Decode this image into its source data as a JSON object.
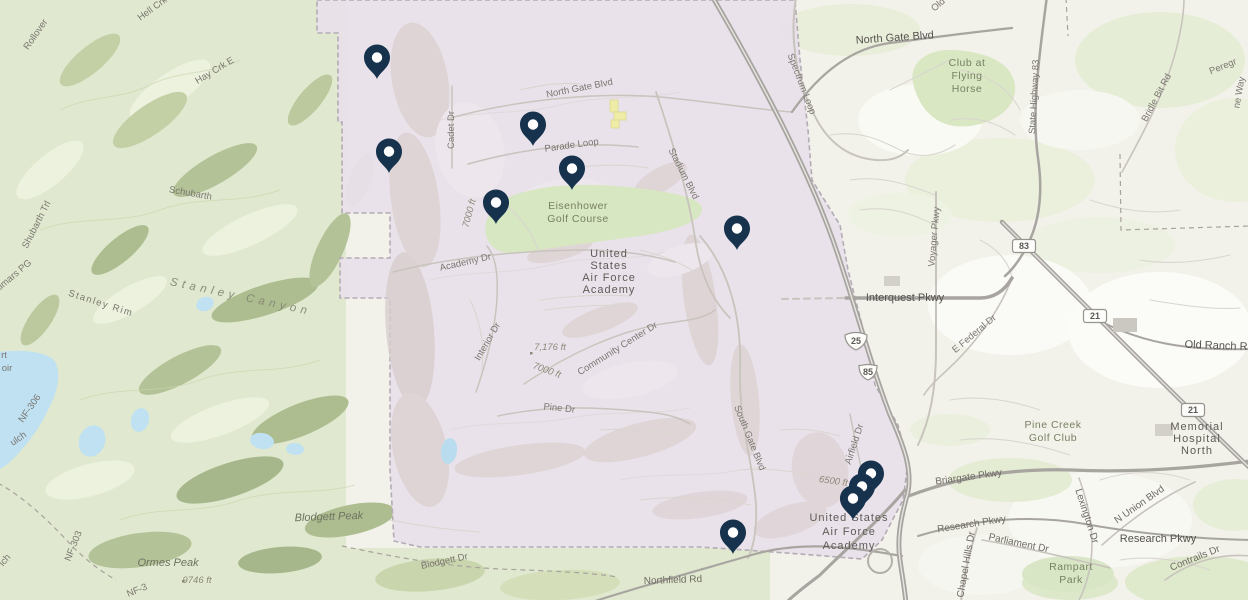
{
  "map": {
    "colors": {
      "pin": "#16324d",
      "pin_hole": "#ffffff",
      "boundary_fill": "#e8e0ea",
      "boundary_stroke": "#b3abb5",
      "terrain_green": "#e0e9cf",
      "urban_cream": "#f3f2ea",
      "water": "#bfe1f1",
      "golf_green": "#d7e7c1",
      "building_yellow": "#eeeca6"
    },
    "labels": [
      {
        "t": "Rollover",
        "x": 38,
        "y": 36,
        "r": -55,
        "s": "roadsm"
      },
      {
        "t": "Hell Crk",
        "x": 154,
        "y": 11,
        "r": -36,
        "s": "roadsm"
      },
      {
        "t": "Hay Crk E",
        "x": 216,
        "y": 73,
        "r": -31,
        "s": "roadsm"
      },
      {
        "t": "Schubarth",
        "x": 190,
        "y": 196,
        "r": 10,
        "s": "roadsm"
      },
      {
        "t": "Shubarth Trl",
        "x": 39,
        "y": 226,
        "r": -63,
        "s": "roadsm"
      },
      {
        "t": "almars PG",
        "x": 15,
        "y": 278,
        "r": -40,
        "s": "roadsm"
      },
      {
        "t": "Stanley Rim",
        "x": 100,
        "y": 306,
        "r": 18,
        "s": "roadsm",
        "ls": 1.5
      },
      {
        "t": "Stanley Canyon",
        "x": 240,
        "y": 300,
        "r": 12,
        "s": "canyon"
      },
      {
        "t": "rt",
        "x": 4,
        "y": 358,
        "s": "roadsm"
      },
      {
        "t": "oir",
        "x": 7,
        "y": 371,
        "s": "roadsm"
      },
      {
        "t": "NF-306",
        "x": 32,
        "y": 410,
        "r": -55,
        "s": "roadsm"
      },
      {
        "t": "ulch",
        "x": 20,
        "y": 441,
        "r": -35,
        "s": "roadsm"
      },
      {
        "t": "lch",
        "x": 7,
        "y": 562,
        "r": -50,
        "s": "roadsm"
      },
      {
        "t": "NF-303",
        "x": 76,
        "y": 547,
        "r": -68,
        "s": "roadsm"
      },
      {
        "t": "Ormes Peak",
        "x": 168,
        "y": 566,
        "s": "peak"
      },
      {
        "t": "9746 ft",
        "x": 197,
        "y": 583,
        "s": "elev"
      },
      {
        "t": "NF-3",
        "x": 138,
        "y": 593,
        "r": -22,
        "s": "roadsm"
      },
      {
        "t": "Blodgett Peak",
        "x": 329,
        "y": 520,
        "r": -2,
        "s": "peak"
      },
      {
        "t": "Blodgett Dr",
        "x": 445,
        "y": 564,
        "r": -12,
        "s": "roadsm"
      },
      {
        "t": "Northfield Rd",
        "x": 673,
        "y": 583,
        "r": -2,
        "s": "road"
      },
      {
        "t": "North Gate Blvd",
        "x": 580,
        "y": 91,
        "r": -11,
        "s": "roadsm"
      },
      {
        "t": "Cadet Dr",
        "x": 454,
        "y": 130,
        "r": -90,
        "s": "roadsm"
      },
      {
        "t": "Parade Loop",
        "x": 572,
        "y": 148,
        "r": -8,
        "s": "roadsm"
      },
      {
        "t": "Stadium Blvd",
        "x": 681,
        "y": 175,
        "r": 63,
        "s": "roadsm"
      },
      {
        "t": "Academy Dr",
        "x": 466,
        "y": 265,
        "r": -13,
        "s": "roadsm"
      },
      {
        "t": "7000 ft",
        "x": 472,
        "y": 214,
        "r": -75,
        "s": "elev"
      },
      {
        "t": "Interior Dr",
        "x": 490,
        "y": 343,
        "r": -60,
        "s": "roadsm"
      },
      {
        "t": "7,176 ft",
        "x": 550,
        "y": 350,
        "s": "elev"
      },
      {
        "t": "7000 ft",
        "x": 546,
        "y": 373,
        "r": 20,
        "s": "elev"
      },
      {
        "t": "Community Center Dr",
        "x": 619,
        "y": 351,
        "r": -32,
        "s": "roadsm"
      },
      {
        "t": "Pine Dr",
        "x": 559,
        "y": 411,
        "r": 6,
        "s": "roadsm"
      },
      {
        "t": "South Gate Blvd",
        "x": 747,
        "y": 439,
        "r": 68,
        "s": "roadsm"
      },
      {
        "t": "Airfield Dr",
        "x": 857,
        "y": 445,
        "r": -72,
        "s": "roadsm"
      },
      {
        "t": "6500 ft",
        "x": 833,
        "y": 484,
        "r": 8,
        "s": "elev"
      },
      {
        "t": "Spectrum Loop",
        "x": 799,
        "y": 85,
        "r": 69,
        "s": "roadsm"
      },
      {
        "t": "Old",
        "x": 940,
        "y": 7,
        "r": -40,
        "s": "roadsm"
      },
      {
        "t": "North Gate Blvd",
        "x": 895,
        "y": 41,
        "r": -4,
        "s": "major"
      },
      {
        "t": "State Highway 83",
        "x": 1037,
        "y": 97,
        "r": -87,
        "s": "roadsm"
      },
      {
        "t": "Bridle Bit Rd",
        "x": 1159,
        "y": 99,
        "r": -62,
        "s": "roadsm"
      },
      {
        "t": "Peregr",
        "x": 1224,
        "y": 69,
        "r": -22,
        "s": "roadsm"
      },
      {
        "t": "ne Way",
        "x": 1242,
        "y": 93,
        "r": -80,
        "s": "roadsm"
      },
      {
        "t": "Voyager Pkwy",
        "x": 937,
        "y": 237,
        "r": -85,
        "s": "roadsm"
      },
      {
        "t": "Interquest Pkwy",
        "x": 905,
        "y": 301,
        "s": "major"
      },
      {
        "t": "E Federal Dr",
        "x": 976,
        "y": 336,
        "r": -40,
        "s": "roadsm"
      },
      {
        "t": "Old Ranch Rd",
        "x": 1219,
        "y": 349,
        "r": 2,
        "s": "major"
      },
      {
        "t": "Briargate Pkwy",
        "x": 969,
        "y": 480,
        "r": -8,
        "s": "road"
      },
      {
        "t": "Research Pkwy",
        "x": 972,
        "y": 527,
        "r": -9,
        "s": "road"
      },
      {
        "t": "Research Pkwy",
        "x": 1158,
        "y": 542,
        "s": "major"
      },
      {
        "t": "Chapel Hills Dr",
        "x": 969,
        "y": 565,
        "r": -80,
        "s": "road"
      },
      {
        "t": "Parliament Dr",
        "x": 1018,
        "y": 546,
        "r": 12,
        "s": "road"
      },
      {
        "t": "Lexington Dr",
        "x": 1084,
        "y": 517,
        "r": 72,
        "s": "road"
      },
      {
        "t": "N Union Blvd",
        "x": 1141,
        "y": 507,
        "r": -35,
        "s": "road"
      },
      {
        "t": "Contrails Dr",
        "x": 1196,
        "y": 561,
        "r": -22,
        "s": "road"
      },
      {
        "lines": [
          "Eisenhower",
          "Golf Course"
        ],
        "x": 578,
        "y": 209,
        "lh": 13,
        "s": "park"
      },
      {
        "lines": [
          "United",
          "States",
          "Air Force",
          "Academy"
        ],
        "x": 609,
        "y": 257,
        "lh": 12,
        "s": "place"
      },
      {
        "lines": [
          "United States",
          "Air Force",
          "Academy"
        ],
        "x": 849,
        "y": 521,
        "lh": 14,
        "s": "place",
        "size": 12.5
      },
      {
        "lines": [
          "Club at",
          "Flying",
          "Horse"
        ],
        "x": 967,
        "y": 66,
        "lh": 13,
        "s": "park"
      },
      {
        "lines": [
          "Pine Creek",
          "Golf Club"
        ],
        "x": 1053,
        "y": 428,
        "lh": 13,
        "s": "park"
      },
      {
        "lines": [
          "Memorial",
          "Hospital",
          "North"
        ],
        "x": 1197,
        "y": 430,
        "lh": 12,
        "s": "place"
      },
      {
        "lines": [
          "Rampart",
          "Park"
        ],
        "x": 1071,
        "y": 570,
        "lh": 13,
        "s": "park"
      }
    ],
    "shields": [
      {
        "kind": "interstate",
        "label": "25",
        "x": 856,
        "y": 341
      },
      {
        "kind": "us",
        "label": "85",
        "x": 868,
        "y": 372
      },
      {
        "kind": "state",
        "label": "83",
        "x": 1024,
        "y": 246
      },
      {
        "kind": "state",
        "label": "21",
        "x": 1095,
        "y": 316
      },
      {
        "kind": "state",
        "label": "21",
        "x": 1193,
        "y": 410
      }
    ],
    "pins": [
      {
        "x": 377,
        "y": 79
      },
      {
        "x": 389,
        "y": 173
      },
      {
        "x": 533,
        "y": 146
      },
      {
        "x": 572,
        "y": 190
      },
      {
        "x": 496,
        "y": 224
      },
      {
        "x": 737,
        "y": 250
      },
      {
        "x": 871,
        "y": 495
      },
      {
        "x": 862,
        "y": 508
      },
      {
        "x": 853,
        "y": 520
      },
      {
        "x": 733,
        "y": 554
      }
    ]
  }
}
